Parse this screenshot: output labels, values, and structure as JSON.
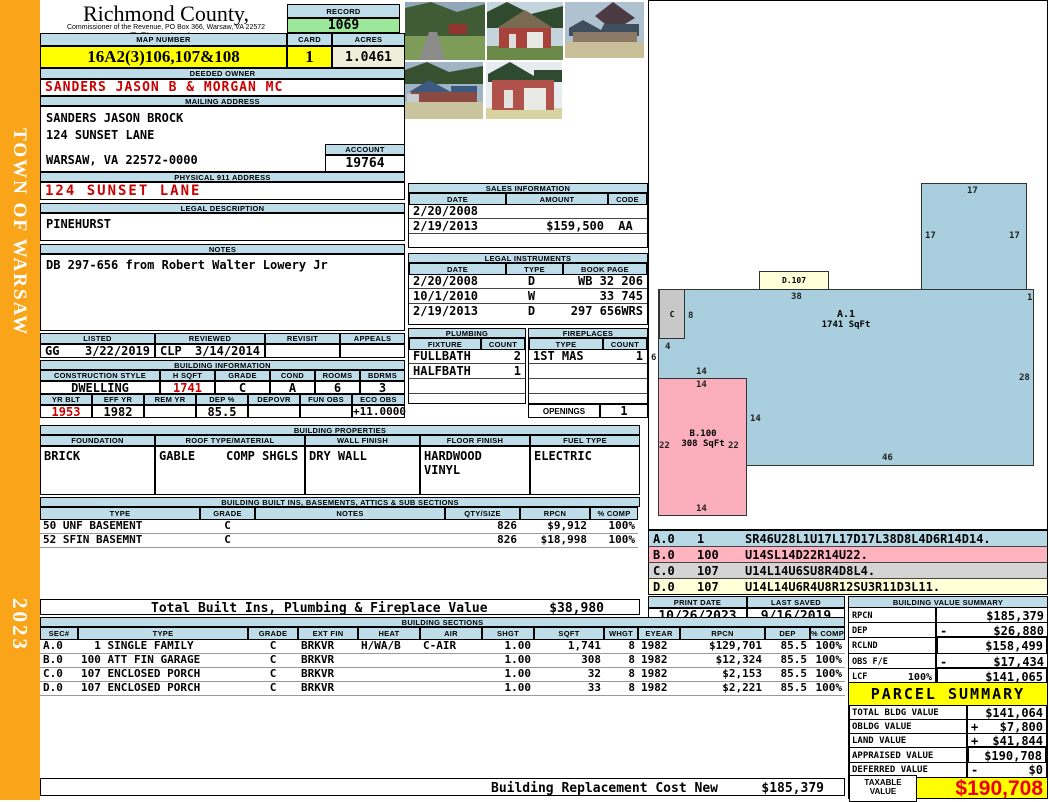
{
  "colors": {
    "sidebar_orange": "#FAA519",
    "header_blue": "#BEDDE9",
    "highlight_yellow": "#FFFF00",
    "record_green": "#9BE89B",
    "acres_beige": "#EFEEDA",
    "alert_red": "#CC0000",
    "taxable_red": "#EE0000",
    "sketch_blue": "#A9CEDD",
    "sketch_pink": "#FBAEBC",
    "sketch_gray": "#C8C8C8",
    "sketch_cream": "#FFFFD8"
  },
  "sidebar": {
    "vertical_text": "TOWN OF WARSAW",
    "year": "2023"
  },
  "header": {
    "county": "Richmond County, Virginia",
    "commissioner": "Commissioner of the Revenue, PO Box 366, Warsaw, VA 22572",
    "record_label": "RECORD",
    "record_number": "1069",
    "map_number_label": "MAP NUMBER",
    "map_number": "16A2(3)106,107&108",
    "card_label": "CARD",
    "card": "1",
    "acres_label": "ACRES",
    "acres": "1.0461"
  },
  "owner": {
    "deeded_owner_label": "DEEDED OWNER",
    "deeded_owner": "SANDERS JASON B & MORGAN MC",
    "mailing_address_label": "MAILING ADDRESS",
    "mailing_line1": "SANDERS JASON BROCK",
    "mailing_line2": "124 SUNSET LANE",
    "mailing_line3": "WARSAW, VA 22572-0000",
    "account_label": "ACCOUNT",
    "account": "19764",
    "physical_address_label": "PHYSICAL 911 ADDRESS",
    "physical_address": "124 SUNSET LANE",
    "legal_description_label": "LEGAL DESCRIPTION",
    "legal_description": "PINEHURST",
    "notes_label": "NOTES",
    "notes": "DB 297-656 from Robert Walter Lowery Jr"
  },
  "review": {
    "listed_label": "LISTED",
    "reviewed_label": "REVIEWED",
    "revisit_label": "REVISIT",
    "appeals_label": "APPEALS",
    "listed_by": "GG",
    "listed_date": "3/22/2019",
    "reviewed_by": "CLP",
    "reviewed_date": "3/14/2014",
    "revisit": "",
    "appeals": ""
  },
  "building_info": {
    "title": "BUILDING INFORMATION",
    "construction_style_label": "CONSTRUCTION STYLE",
    "h_sqft_label": "H SQFT",
    "grade_label": "GRADE",
    "cond_label": "COND",
    "rooms_label": "ROOMS",
    "bdrms_label": "BDRMS",
    "construction_style": "DWELLING",
    "h_sqft": "1741",
    "grade": "C",
    "cond": "A",
    "rooms": "6",
    "bdrms": "3",
    "yr_blt_label": "YR BLT",
    "eff_yr_label": "EFF YR",
    "rem_yr_label": "REM YR",
    "dep_pct_label": "DEP %",
    "depovr_label": "DEPOVR",
    "fun_obs_label": "FUN OBS",
    "eco_obs_label": "ECO OBS",
    "yr_blt": "1953",
    "eff_yr": "1982",
    "rem_yr": "",
    "dep_pct": "85.5",
    "depovr": "",
    "fun_obs": "",
    "eco_obs": "+11.0000"
  },
  "properties": {
    "title": "BUILDING PROPERTIES",
    "foundation_label": "FOUNDATION",
    "roof_label": "ROOF TYPE/MATERIAL",
    "wall_label": "WALL FINISH",
    "floor_label": "FLOOR FINISH",
    "fuel_label": "FUEL TYPE",
    "foundation": "BRICK",
    "roof_type": "GABLE",
    "roof_material": "COMP SHGLS",
    "wall_finish": "DRY WALL",
    "floor_finish_1": "HARDWOOD",
    "floor_finish_2": "VINYL",
    "fuel_type": "ELECTRIC"
  },
  "built_ins": {
    "title": "BUILDING BUILT INS, BASEMENTS, ATTICS & SUB SECTIONS",
    "type_label": "TYPE",
    "grade_label": "GRADE",
    "notes_label": "NOTES",
    "qty_label": "QTY/SIZE",
    "rpcn_label": "RPCN",
    "comp_label": "% COMP",
    "rows": [
      {
        "type": "50 UNF BASEMENT",
        "grade": "C",
        "notes": "",
        "qty": "826",
        "rpcn": "$9,912",
        "comp": "100%"
      },
      {
        "type": "52 SFIN BASEMNT",
        "grade": "C",
        "notes": "",
        "qty": "826",
        "rpcn": "$18,998",
        "comp": "100%"
      }
    ],
    "total_label": "Total Built Ins, Plumbing & Fireplace Value",
    "total_value": "$38,980"
  },
  "sales": {
    "title": "SALES INFORMATION",
    "date_label": "DATE",
    "amount_label": "AMOUNT",
    "code_label": "CODE",
    "rows": [
      {
        "date": "2/20/2008",
        "amount": "",
        "code": ""
      },
      {
        "date": "2/19/2013",
        "amount": "$159,500",
        "code": "AA"
      },
      {
        "date": "",
        "amount": "",
        "code": ""
      }
    ]
  },
  "instruments": {
    "title": "LEGAL INSTRUMENTS",
    "date_label": "DATE",
    "type_label": "TYPE",
    "book_label": "BOOK PAGE",
    "rows": [
      {
        "date": "2/20/2008",
        "type": "D",
        "book": "WB 32 206"
      },
      {
        "date": "10/1/2010",
        "type": "W",
        "book": "33 745"
      },
      {
        "date": "2/19/2013",
        "type": "D",
        "book": "297 656WRS"
      }
    ]
  },
  "plumbing": {
    "title": "PLUMBING",
    "fixture_label": "FIXTURE",
    "count_label": "COUNT",
    "rows": [
      {
        "fixture": "FULLBATH",
        "count": "2"
      },
      {
        "fixture": "HALFBATH",
        "count": "1"
      },
      {
        "fixture": "",
        "count": ""
      },
      {
        "fixture": "",
        "count": ""
      }
    ]
  },
  "fireplaces": {
    "title": "FIREPLACES",
    "type_label": "TYPE",
    "count_label": "COUNT",
    "rows": [
      {
        "type": "1ST MAS",
        "count": "1"
      },
      {
        "type": "",
        "count": ""
      },
      {
        "type": "",
        "count": ""
      },
      {
        "type": "",
        "count": ""
      }
    ],
    "openings_label": "OPENINGS",
    "openings_count": "1"
  },
  "sketch": {
    "area_a_label": "A.1",
    "area_a_sqft": "1741 SqFt",
    "area_b_label": "B.100",
    "area_b_sqft": "308 SqFt",
    "area_c_label": "C",
    "area_d_label": "D.107",
    "dims": {
      "tab_top": "17",
      "tab_left": "17",
      "tab_right": "17",
      "top_edge": "38",
      "right_notch": "1",
      "c_right": "8",
      "c_below": "4",
      "left_edge": "6",
      "b_above": "14",
      "b_top": "14",
      "b_right_edge": "14",
      "b_left": "22",
      "b_right": "22",
      "b_bottom": "14",
      "right_edge": "28",
      "bottom_edge": "46"
    }
  },
  "vectors": {
    "rows": [
      {
        "sec": "A.0",
        "code": "1",
        "path": "SR46U28L1U17L17D17L38D8L4D6R14D14."
      },
      {
        "sec": "B.0",
        "code": "100",
        "path": "U14SL14D22R14U22."
      },
      {
        "sec": "C.0",
        "code": "107",
        "path": "U14L14U6SU8R4D8L4."
      },
      {
        "sec": "D.0",
        "code": "107",
        "path": "U14L14U6R4U8R12SU3R11D3L11."
      }
    ]
  },
  "meta": {
    "print_date_label": "PRINT DATE",
    "print_date": "10/26/2023",
    "last_saved_label": "LAST SAVED",
    "last_saved": "9/16/2019"
  },
  "value_summary": {
    "title": "BUILDING VALUE SUMMARY",
    "rows": [
      {
        "label": "RPCN",
        "pct": "",
        "sign": "",
        "value": "$185,379"
      },
      {
        "label": "DEP",
        "pct": "",
        "sign": "-",
        "value": "$26,880"
      },
      {
        "label": "RCLND",
        "pct": "",
        "sign": "",
        "value": "$158,499"
      },
      {
        "label": "OBS F/E",
        "pct": "",
        "sign": "-",
        "value": "$17,434"
      },
      {
        "label": "LCF",
        "pct": "100%",
        "sign": "",
        "value": "$141,065"
      }
    ]
  },
  "sections": {
    "title": "BUILDING SECTIONS",
    "headers": {
      "sec": "SEC#",
      "type": "TYPE",
      "grade": "GRADE",
      "ext": "EXT FIN",
      "heat": "HEAT",
      "air": "AIR",
      "shgt": "SHGT",
      "sqft": "SQFT",
      "whgt": "WHGT",
      "eyear": "EYEAR",
      "rpcn": "RPCN",
      "dep": "DEP",
      "comp": "% COMP"
    },
    "rows": [
      {
        "sec": "A.0",
        "type": "  1 SINGLE FAMILY",
        "grade": "C",
        "ext": "BRKVR",
        "heat": "H/WA/B",
        "air": "C-AIR",
        "shgt": "1.00",
        "sqft": "1,741",
        "whgt": "8",
        "eyear": "1982",
        "rpcn": "$129,701",
        "dep": "85.5",
        "comp": "100%"
      },
      {
        "sec": "B.0",
        "type": "100 ATT FIN GARAGE",
        "grade": "C",
        "ext": "BRKVR",
        "heat": "",
        "air": "",
        "shgt": "1.00",
        "sqft": "308",
        "whgt": "8",
        "eyear": "1982",
        "rpcn": "$12,324",
        "dep": "85.5",
        "comp": "100%"
      },
      {
        "sec": "C.0",
        "type": "107 ENCLOSED PORCH",
        "grade": "C",
        "ext": "BRKVR",
        "heat": "",
        "air": "",
        "shgt": "1.00",
        "sqft": "32",
        "whgt": "8",
        "eyear": "1982",
        "rpcn": "$2,153",
        "dep": "85.5",
        "comp": "100%"
      },
      {
        "sec": "D.0",
        "type": "107 ENCLOSED PORCH",
        "grade": "C",
        "ext": "BRKVR",
        "heat": "",
        "air": "",
        "shgt": "1.00",
        "sqft": "33",
        "whgt": "8",
        "eyear": "1982",
        "rpcn": "$2,221",
        "dep": "85.5",
        "comp": "100%"
      }
    ]
  },
  "replacement": {
    "label": "Building Replacement Cost New",
    "value": "$185,379"
  },
  "parcel_summary": {
    "title": "PARCEL SUMMARY",
    "rows": [
      {
        "label": "TOTAL BLDG VALUE",
        "sign": "",
        "value": "$141,064"
      },
      {
        "label": "OBLDG VALUE",
        "sign": "+",
        "value": "$7,800"
      },
      {
        "label": "LAND VALUE",
        "sign": "+",
        "value": "$41,844"
      },
      {
        "label": "APPRAISED VALUE",
        "sign": "",
        "value": "$190,708"
      },
      {
        "label": "DEFERRED VALUE",
        "sign": "-",
        "value": "$0"
      }
    ],
    "taxable_label_line1": "TAXABLE",
    "taxable_label_line2": "VALUE",
    "taxable_value": "$190,708"
  }
}
